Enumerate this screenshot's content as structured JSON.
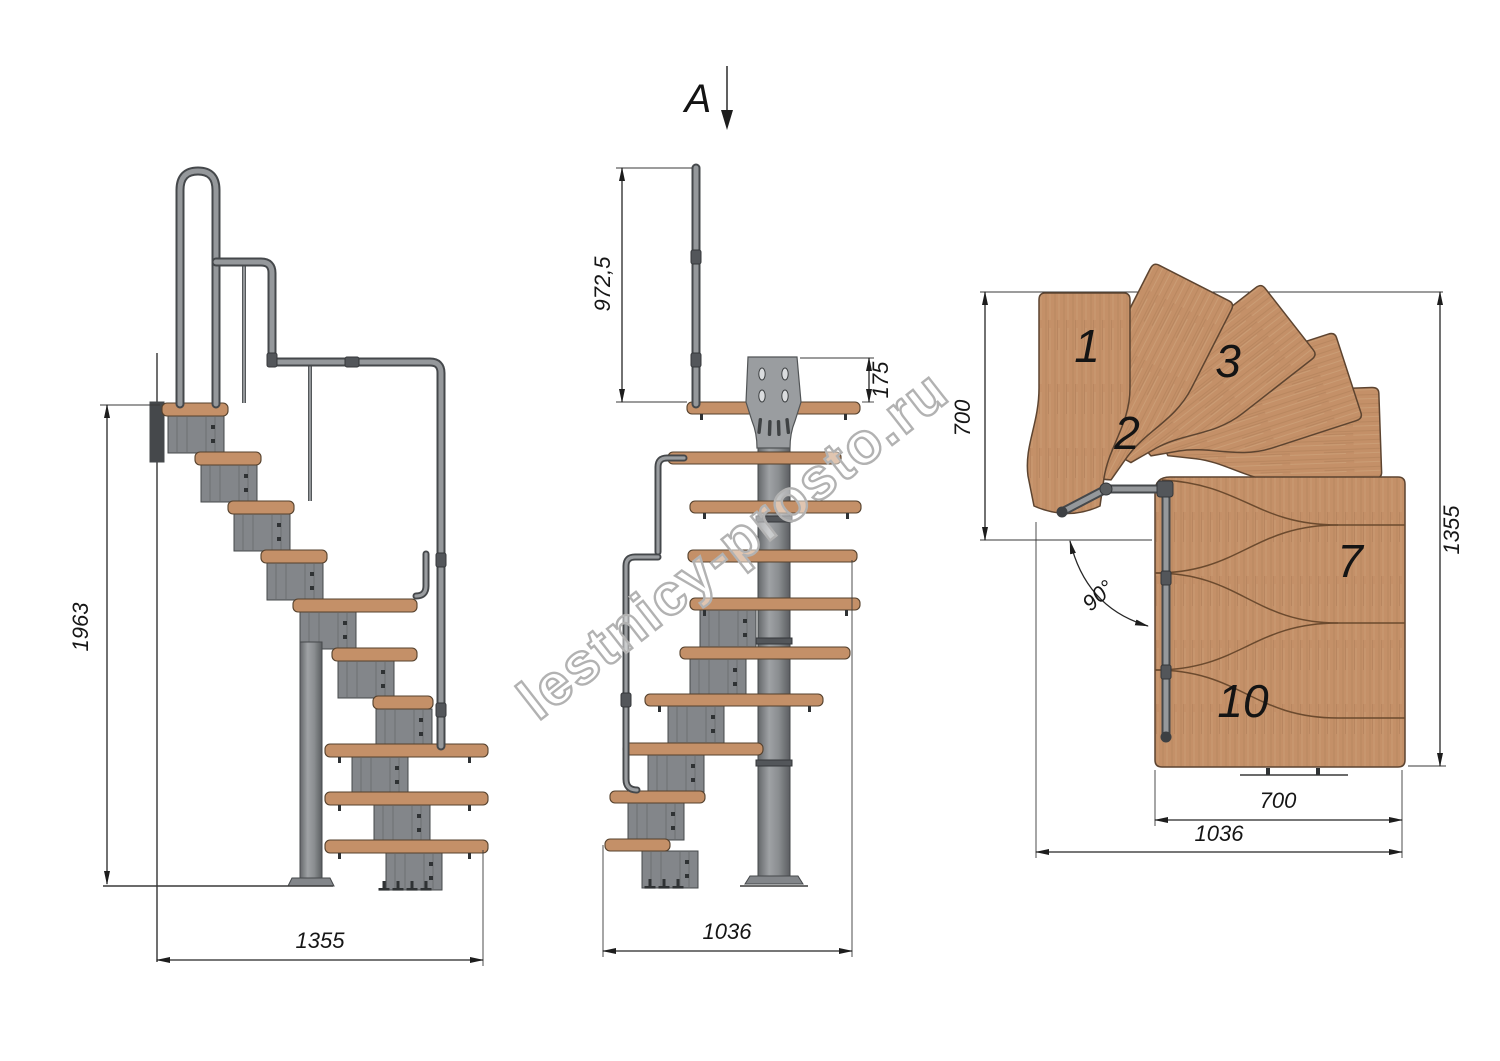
{
  "watermark": "lestnicy-prosto.ru",
  "view_arrow": {
    "label": "A"
  },
  "side_view": {
    "dim_total_height": "1963",
    "dim_total_width": "1355"
  },
  "front_view": {
    "dim_handrail_height": "972,5",
    "dim_plate_offset": "175",
    "dim_total_width": "1036"
  },
  "plan_view": {
    "dim_entry_width": "700",
    "dim_total_depth": "1355",
    "dim_flight_width": "700",
    "dim_total_width": "1036",
    "turn_angle": "90°",
    "treads": {
      "n1": "1",
      "n2": "2",
      "n3": "3",
      "n7": "7",
      "n10": "10"
    }
  },
  "colors": {
    "wood": "#c49068",
    "wood_dark": "#8a6644",
    "wood_outline": "#54402c",
    "metal": "#83868a",
    "metal_light": "#9a9da0",
    "metal_dark": "#45484b",
    "line": "#262626",
    "watermark": "#b2b2b2"
  }
}
